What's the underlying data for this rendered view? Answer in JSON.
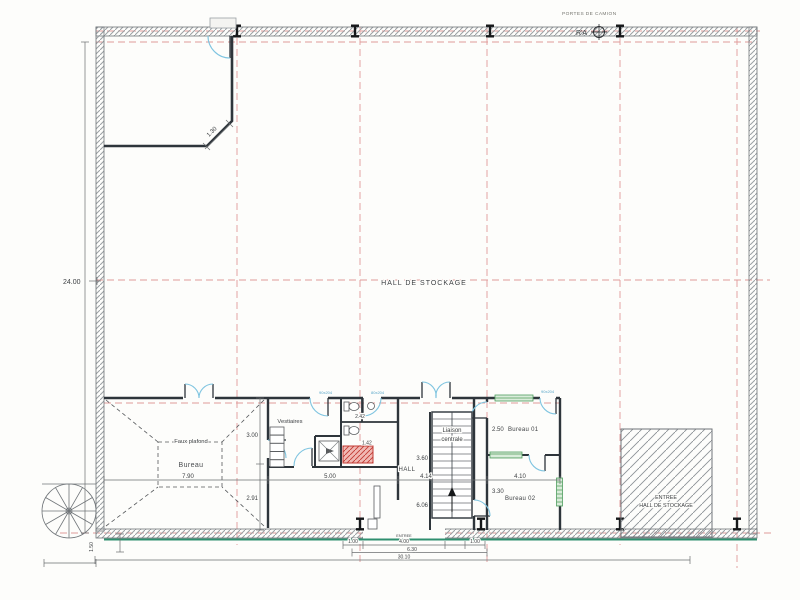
{
  "plan": {
    "top_note": "PORTES DE CAMION",
    "survey_marker": "R'A",
    "hall_label": "HALL DE STOCKAGE",
    "rooms": {
      "bureau": "Bureau",
      "faux_plafond": "Faux plafond",
      "vestiaires": "Vestiaires",
      "hall": "HALL",
      "liaison_line1": "Liaison",
      "liaison_line2": "centrale",
      "bureau01": "Bureau 01",
      "bureau02": "Bureau 02",
      "entree_line1": "ENTREE",
      "entree_line2": "HALL DE STOCKAGE",
      "entree_door": "ENTREE"
    },
    "dims": {
      "height_total": "24.00",
      "chamfer": "1.30",
      "bureau_width": "7.90",
      "bureau_h1": "3.00",
      "bureau_h2": "2.91",
      "vest_width": "5.00",
      "wc_dim": "2.42",
      "red_zone": "1.42",
      "stair_1": "3.60",
      "stair_2": "4.14",
      "stair_3": "6.06",
      "b01_h": "2.50",
      "b02_h": "3.30",
      "b_width": "4.10",
      "ent_left": "1.00",
      "ent_width": "4.00",
      "ent_right": "1.00",
      "ent_total": "6.30",
      "total_width": "30.10",
      "stair_out": "1.50"
    },
    "door_labels": {
      "d1": "90x204",
      "d2": "80x204",
      "d3": "90x204"
    },
    "colors": {
      "wall": "#2e353b",
      "grid_red": "#e09a9a",
      "door_blue": "#7ec4e0",
      "window_green": "#4f9e5f",
      "hatch_gray": "#9aa0a4",
      "red_zone_fill": "#f0b9b4",
      "red_zone_line": "#c23b34",
      "storefront_teal": "#2f8f6f"
    }
  }
}
